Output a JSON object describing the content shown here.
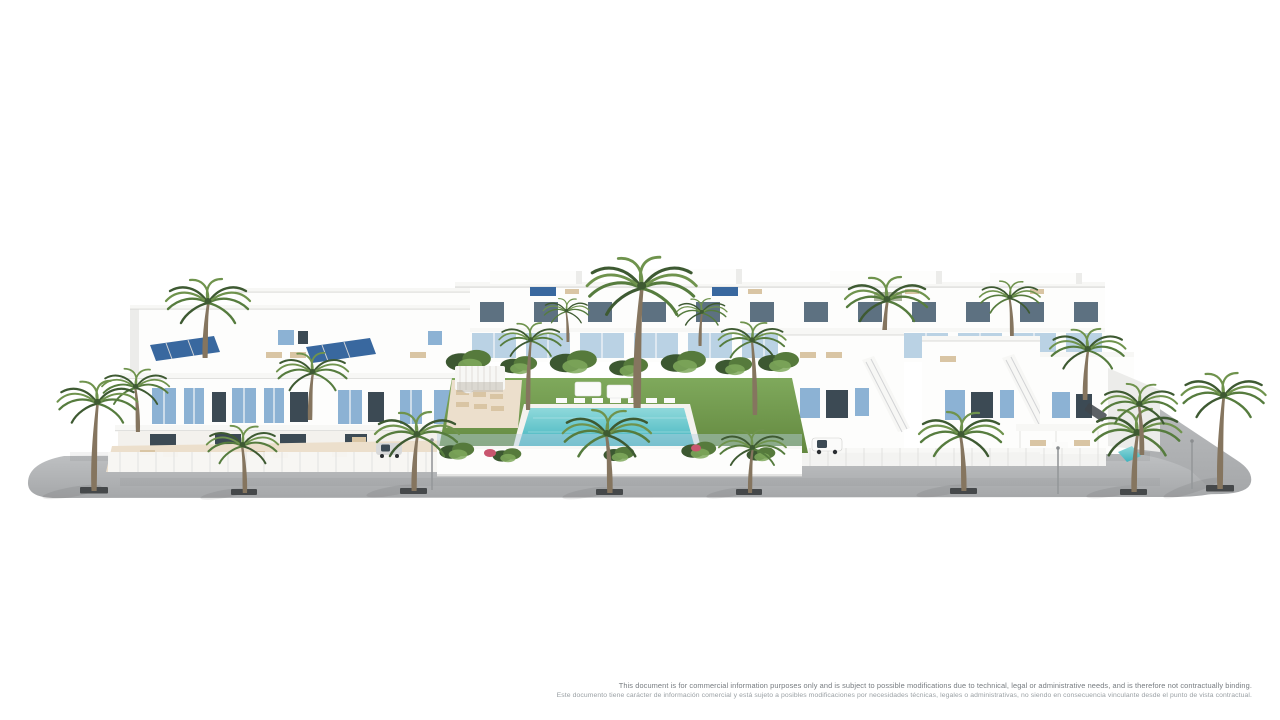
{
  "scene": {
    "type": "architectural-3d-render",
    "description": "Aerial 3D visualisation of a white Mediterranean residential development: rows of modern townhouses and villas with light-blue shutters and glass balconies, rooftop terraces with solar panels and sun loungers, a palm-lined grey street in front, and a central communal garden with lawn, pergolas and a turquoise swimming pool surrounded by white sun loungers.",
    "colors": {
      "background": "#ffffff",
      "building_white": "#fdfdfc",
      "building_shade": "#ececea",
      "building_shade_dark": "#dadad8",
      "parapet_line": "#f7f7f5",
      "window_glass": "#5d7181",
      "window_glass_dark": "#3c4a54",
      "shutter_blue": "#8cb2d4",
      "balcony_glass": "#b7d0e3",
      "solar_panel": "#39689f",
      "solar_panel_dark": "#27517f",
      "terrace_floor": "#ecdfcc",
      "lounger_beige": "#d9c5a4",
      "lounger_white": "#fbfbfa",
      "lawn_green": "#63883f",
      "lawn_green_light": "#7fa95c",
      "bush_green": "#567a3c",
      "bush_green_dark": "#3c5831",
      "palm_frond": "#567c3e",
      "palm_frond_dark": "#3e5a32",
      "palm_frond_light": "#6f934d",
      "palm_trunk": "#85755f",
      "pool_water": "#3fb2bd",
      "pool_water_light": "#8fd9db",
      "pool_coping": "#f4f2ee",
      "road_gray_light": "#c0c2c4",
      "road_gray_dark": "#a5a7a9",
      "tree_grate": "#45484a",
      "fence_white": "#f7f7f5",
      "car_silver": "#d8d9da",
      "car_dark": "#3f454b",
      "flower_pink": "#c9566f",
      "text_gray_dark": "#777c80",
      "text_gray_light": "#9aa0a4"
    }
  },
  "footer": {
    "disclaimer_en": "This document is for commercial information purposes only and is subject to possible modifications due to technical, legal or administrative needs, and is therefore not contractually binding.",
    "disclaimer_es": "Este documento tiene carácter de información comercial y está sujeto a posibles modificaciones por necesidades técnicas, legales o administrativas, no siendo en consecuencia vinculante desde el punto de vista contractual."
  }
}
